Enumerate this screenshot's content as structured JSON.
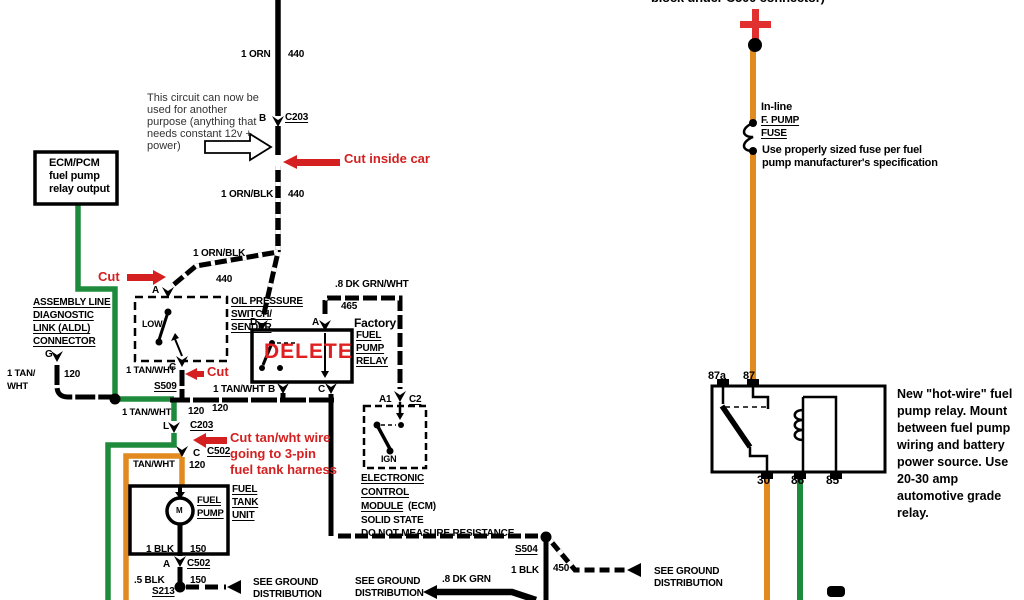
{
  "palette": {
    "background": "#ffffff",
    "wire_black": "#000000",
    "wire_green": "#1e8b3c",
    "wire_orange": "#e08a20",
    "annotation_red": "#d42020",
    "delete_red": "#e02020"
  },
  "top": {
    "c500_note": "block under C500 connector)",
    "wire_orn": {
      "gauge": "1 ORN",
      "circuit": "440"
    },
    "c203_top": {
      "pin": "B",
      "name": "C203"
    },
    "reuse_note": [
      "This circuit can now be",
      "used for another",
      "purpose (anything that",
      "needs constant 12v +",
      "power)"
    ],
    "cut_inside_car": "Cut inside car",
    "wire_ornblk": {
      "gauge": "1 ORN/BLK",
      "circuit": "440"
    },
    "wire_ornblk2": {
      "gauge": "1 ORN/BLK",
      "circuit": "440"
    },
    "cut": "Cut"
  },
  "ecm_pcm_box": {
    "lines": [
      "ECM/PCM",
      "fuel pump",
      "relay output"
    ]
  },
  "aldl": {
    "title": [
      "ASSEMBLY LINE",
      "DIAGNOSTIC",
      "LINK (ALDL)",
      "CONNECTOR"
    ],
    "pin": "G",
    "wire_l1": "1 TAN/",
    "wire_l2": "WHT",
    "circuit": "120"
  },
  "oil_switch": {
    "pin_a": "A",
    "title": [
      "OIL PRESSURE",
      "SWITCH/",
      "SENDER"
    ],
    "low": "LOW",
    "pin_c": "C",
    "wire": "1 TAN/WHT",
    "cut": "Cut",
    "splice": "S509"
  },
  "factory_relay": {
    "pin_d": "D",
    "pin_a": "A",
    "pin_b": "B",
    "pin_c": "C",
    "delete": "DELETE",
    "caption": "Factory",
    "title": [
      "FUEL",
      "PUMP",
      "RELAY"
    ],
    "wire_grnwht": ".8 DK GRN/WHT",
    "circuit_465": "465",
    "wire_b": "1 TAN/WHT"
  },
  "mid": {
    "wire_tanwht": "1 TAN/WHT",
    "circuit_120a": "120",
    "circuit_120b": "120",
    "c203": {
      "pin": "L",
      "name": "C203"
    },
    "cut_note": [
      "Cut tan/wht wire",
      "going to 3-pin",
      "fuel tank harness"
    ],
    "c502": {
      "pin": "C",
      "name": "C502"
    },
    "wire_tanwht2": "TAN/WHT",
    "circuit_120c": "120"
  },
  "ecm": {
    "pin_a1": "A1",
    "conn_c2": "C2",
    "ign": "IGN",
    "title": [
      "ELECTRONIC",
      "CONTROL",
      "MODULE"
    ],
    "title_suffix": "(ECM)",
    "line4": "SOLID STATE",
    "line5": "DO NOT MEASURE RESISTANCE"
  },
  "fuel_tank": {
    "pump": [
      "FUEL",
      "PUMP"
    ],
    "motor": "M",
    "unit": [
      "FUEL",
      "TANK",
      "UNIT"
    ],
    "wire_blk": "1 BLK",
    "circuit_150a": "150",
    "c502b": {
      "pin": "A",
      "name": "C502"
    },
    "wire_blk5": ".5 BLK",
    "circuit_150b": "150",
    "splice": "S213"
  },
  "grounds": {
    "see_ground": "SEE GROUND",
    "distribution": "DISTRIBUTION",
    "s504": "S504",
    "wire_blk": "1 BLK",
    "circuit_450": "450",
    "wire_dkgrn": ".8 DK GRN"
  },
  "battery_fuse": {
    "inline": "In-line",
    "fpump": "F. PUMP",
    "fuse": "FUSE",
    "note": [
      "Use properly sized fuse per fuel",
      "pump manufacturer's specification"
    ]
  },
  "new_relay": {
    "t87a": "87a",
    "t87": "87",
    "t30": "30",
    "t86": "86",
    "t85": "85",
    "note": [
      "New \"hot-wire\" fuel",
      "pump relay.  Mount",
      "between fuel pump",
      "wiring and battery",
      "power source. Use",
      "20-30 amp",
      "automotive grade",
      "relay."
    ]
  }
}
